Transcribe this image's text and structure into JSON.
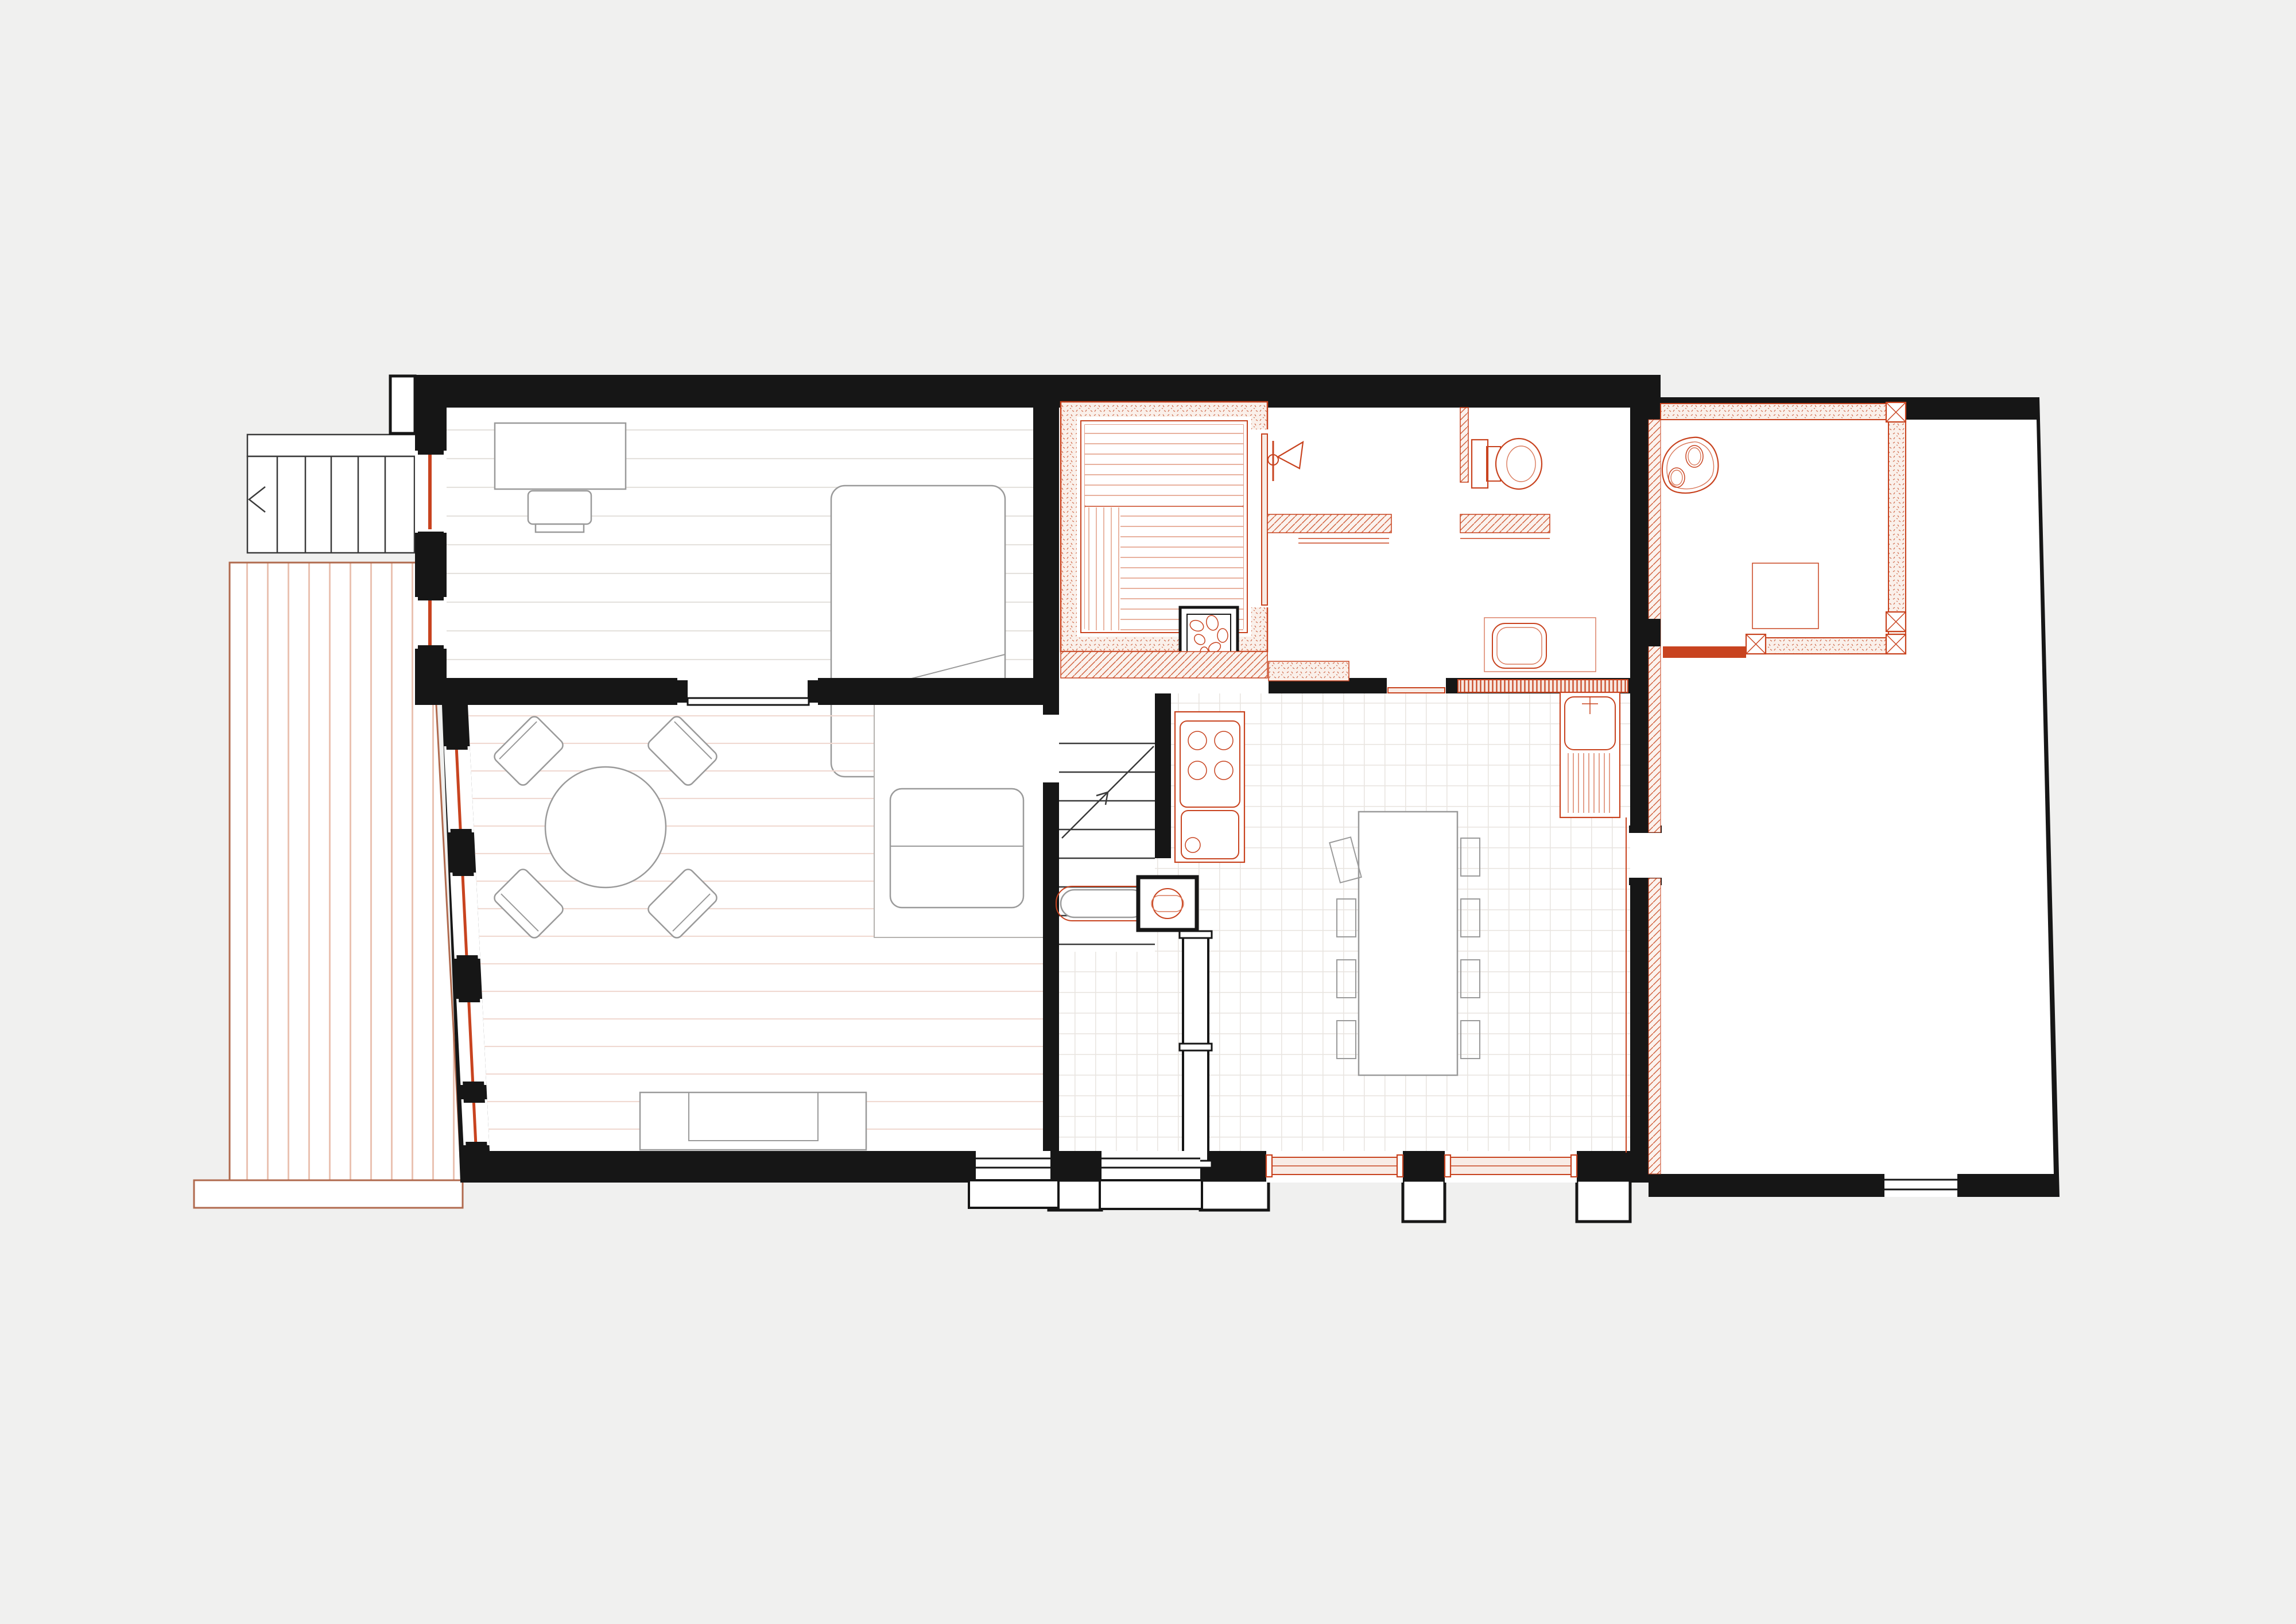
{
  "document": {
    "title": "Ground floor renovation plan",
    "type": "architectural-floor-plan",
    "visible_text": []
  },
  "colors": {
    "background": "#f0f0ef",
    "wall": "#161616",
    "existing_line": "#3a3a3a",
    "furniture_grey": "#9a9a9a",
    "floor_line_grey": "#e4e1dd",
    "floor_line_pink": "#f0d9d1",
    "tile_line": "#e9e5e1",
    "accent_red": "#c8431f",
    "red_soft": "#d9785a",
    "red_pale_fill": "#f8ece6",
    "red_hatch_line": "#d05f3b",
    "red_stipple_dot": "#cf6a4b",
    "sauna_plank": "#e0977e",
    "deck_outline": "#b06a4e",
    "deck_plank": "#eac2b2"
  },
  "rooms": {
    "bedroom": {
      "label": "Bedroom with desk, chair and double bed"
    },
    "living_room": {
      "label": "Living room with round table, four chairs, sofa platform and bench"
    },
    "hall": {
      "label": "Hall with staircase, wood stove, stove bench and glazed partition"
    },
    "kitchen": {
      "label": "Kitchen / dining with hob counter, island table, eight chairs and sink counter"
    },
    "sauna": {
      "label": "Sauna with tiered benches, stone heater and door"
    },
    "bathroom": {
      "label": "Shower room with shower, bench, toilet, washbasin vanity and radiator"
    },
    "annex": {
      "label": "Annex with new insulated room, rock feature and floor mat"
    },
    "terrace": {
      "label": "Timber deck terrace with step"
    },
    "exterior_stair": {
      "label": "Exterior stair with landing and direction arrow"
    }
  },
  "fixtures": {
    "bedroom": [
      "desk",
      "desk-chair",
      "double-bed"
    ],
    "living_room": [
      "round-dining-table",
      "chair-x4",
      "sofa",
      "bench-seat"
    ],
    "hall": [
      "staircase",
      "wood-stove",
      "stove-bench",
      "glazed-partition",
      "front-door"
    ],
    "kitchen": [
      "hob-counter-with-sink",
      "island-dining-table",
      "chair-x8",
      "sink-counter-with-drainboard",
      "new-window-x2"
    ],
    "sauna": [
      "upper-bench",
      "lower-bench",
      "stone-heater",
      "sauna-door"
    ],
    "bathroom": [
      "shower",
      "shower-bench",
      "toilet",
      "wc-partition",
      "washbasin-vanity",
      "radiator",
      "door-threshold"
    ],
    "annex": [
      "new-room-walls",
      "timber-posts",
      "new-door",
      "rock-feature",
      "floor-mat"
    ],
    "exterior": [
      "timber-deck",
      "deck-step",
      "exterior-stair",
      "stair-landing",
      "west-window-x6"
    ]
  }
}
